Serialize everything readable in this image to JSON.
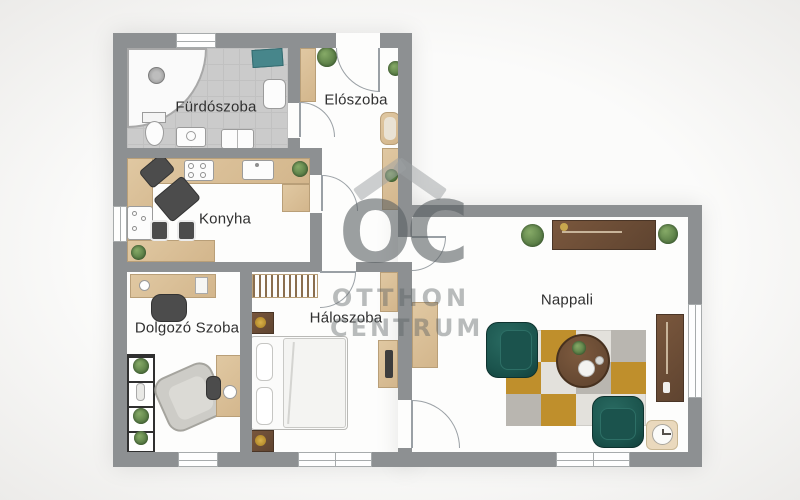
{
  "floorplan": {
    "rooms": [
      {
        "id": "bathroom",
        "label": "Fürdószoba"
      },
      {
        "id": "hallway",
        "label": "Elószoba"
      },
      {
        "id": "kitchen",
        "label": "Konyha"
      },
      {
        "id": "study",
        "label": "Dolgozó Szoba"
      },
      {
        "id": "bedroom",
        "label": "Háloszoba"
      },
      {
        "id": "living_room",
        "label": "Nappali"
      }
    ],
    "watermark": {
      "logo_text": "OC",
      "name_line1": "OTTHON",
      "name_line2": "CENTRUM"
    },
    "colors": {
      "wall_gray": "#8d9092",
      "bathroom_tile": "#cbcbcb",
      "wood_light": "#dcc29a",
      "wood_dark": "#6d4c34",
      "accent_teal": "#1d5b55",
      "accent_mustard": "#bf8f2c",
      "rug_gray": "#b9b6b0",
      "plant_green": "#5f8450",
      "watermark_gray": "#9aa0a2"
    }
  }
}
